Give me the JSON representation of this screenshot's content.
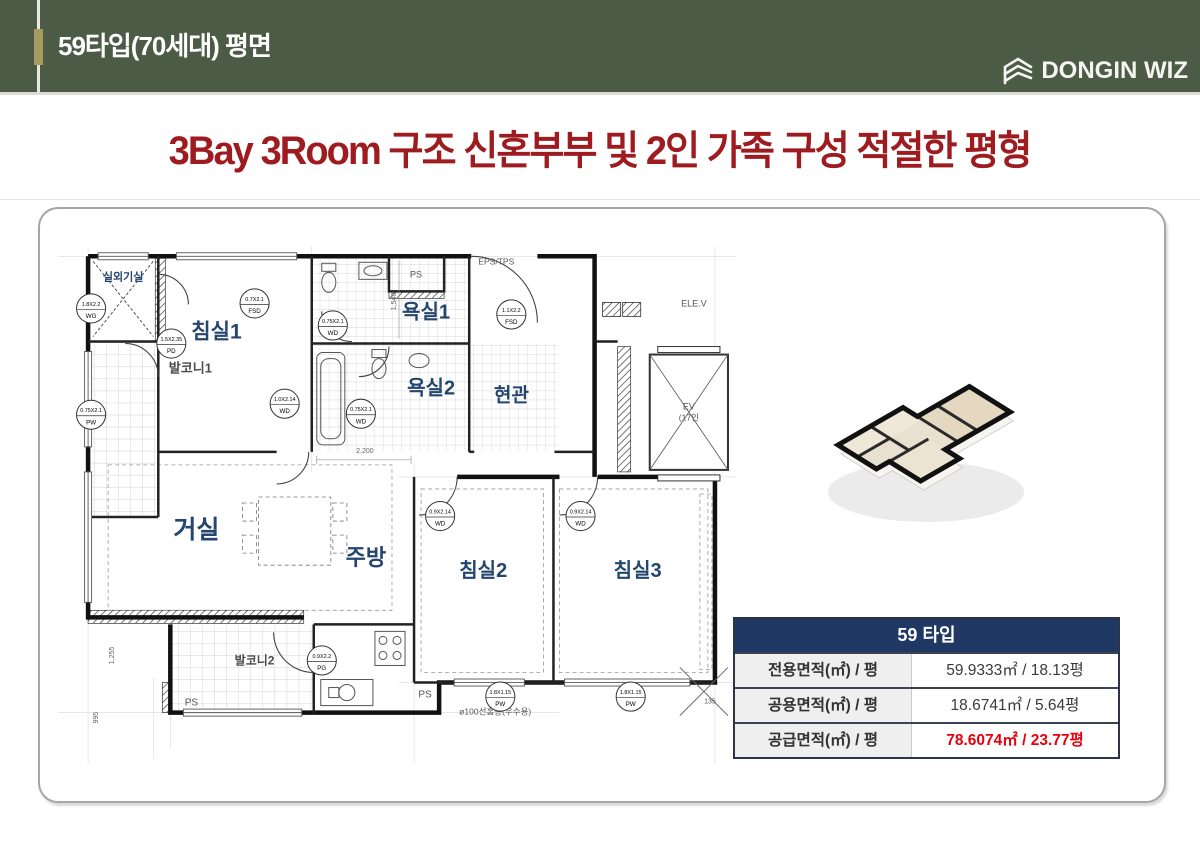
{
  "header": {
    "title": "59타입(70세대) 평면",
    "logo_text": "DONGIN WIZ",
    "bg_color": "#4c5b45",
    "accent_color": "#a69a5e"
  },
  "headline": {
    "text": "3Bay 3Room 구조 신혼부부 및 2인 가족 구성 적절한 평형",
    "color": "#9e1c20"
  },
  "floorplan": {
    "label_color": "#23456e",
    "room_labels": [
      {
        "text": "실외기실",
        "x": 65,
        "y": 34,
        "size": 11
      },
      {
        "text": "침실1",
        "x": 158,
        "y": 92,
        "size": 21
      },
      {
        "text": "욕실1",
        "x": 367,
        "y": 72,
        "size": 20
      },
      {
        "text": "욕실2",
        "x": 372,
        "y": 148,
        "size": 20
      },
      {
        "text": "현관",
        "x": 452,
        "y": 155,
        "size": 19
      },
      {
        "text": "거실",
        "x": 138,
        "y": 291,
        "size": 25
      },
      {
        "text": "주방",
        "x": 307,
        "y": 318,
        "size": 22
      },
      {
        "text": "침실2",
        "x": 424,
        "y": 330,
        "size": 20
      },
      {
        "text": "침실3",
        "x": 578,
        "y": 330,
        "size": 20
      },
      {
        "text": "발코니1",
        "x": 132,
        "y": 126,
        "size": 13,
        "color": "#4a4a4a"
      },
      {
        "text": "발코니2",
        "x": 196,
        "y": 417,
        "size": 12,
        "color": "#4a4a4a"
      }
    ],
    "cad_labels": [
      {
        "text": "PS",
        "x": 357,
        "y": 31,
        "size": 9
      },
      {
        "text": "EPS/TPS",
        "x": 437,
        "y": 18,
        "size": 8.5
      },
      {
        "text": "ELE.V",
        "x": 634,
        "y": 60,
        "size": 9
      },
      {
        "text": "EV",
        "x": 629,
        "y": 163,
        "size": 9
      },
      {
        "text": "(17인",
        "x": 629,
        "y": 174,
        "size": 8.5
      },
      {
        "text": "PS",
        "x": 133,
        "y": 458,
        "size": 10
      },
      {
        "text": "PS",
        "x": 366,
        "y": 450,
        "size": 10
      },
      {
        "text": "ø100선홈통(우수용)",
        "x": 400,
        "y": 467,
        "size": 8.5,
        "anchor": "start"
      },
      {
        "text": "135",
        "x": 650,
        "y": 456,
        "size": 7
      }
    ],
    "dim_labels": [
      {
        "text": "2,200",
        "x": 306,
        "y": 206,
        "size": 7
      },
      {
        "text": "1,540",
        "x": 337,
        "y": 55,
        "size": 7,
        "rot": true
      },
      {
        "text": "1,255",
        "x": 56,
        "y": 408,
        "size": 7,
        "rot": true
      },
      {
        "text": "995",
        "x": 40,
        "y": 470,
        "size": 7,
        "rot": true
      }
    ],
    "door_tags": [
      {
        "l1": "1.8X2.2",
        "l2": "WG",
        "x": 33,
        "y": 62
      },
      {
        "l1": "0.75X2.1",
        "l2": "PW",
        "x": 33,
        "y": 168
      },
      {
        "l1": "0.7X2.1",
        "l2": "FSD",
        "x": 196,
        "y": 57
      },
      {
        "l1": "1.5X2.35",
        "l2": "PD",
        "x": 113,
        "y": 97
      },
      {
        "l1": "0.75X2.1",
        "l2": "WD",
        "x": 274,
        "y": 79
      },
      {
        "l1": "1.1X2.2",
        "l2": "FSD",
        "x": 452,
        "y": 68
      },
      {
        "l1": "1.0X2.14",
        "l2": "WD",
        "x": 226,
        "y": 157
      },
      {
        "l1": "0.75X2.1",
        "l2": "WD",
        "x": 302,
        "y": 167
      },
      {
        "l1": "0.9X2.14",
        "l2": "WD",
        "x": 381,
        "y": 269
      },
      {
        "l1": "0.9X2.14",
        "l2": "WD",
        "x": 521,
        "y": 269
      },
      {
        "l1": "0.9X2.2",
        "l2": "PG",
        "x": 263,
        "y": 413
      },
      {
        "l1": "1.8X1.15",
        "l2": "PW",
        "x": 441,
        "y": 449
      },
      {
        "l1": "1.8X1.15",
        "l2": "PW",
        "x": 571,
        "y": 449
      }
    ]
  },
  "spec_table": {
    "title": "59 타입",
    "header_bg": "#1f3864",
    "highlight_color": "#e8000d",
    "rows": [
      {
        "label": "전용면적(㎡) / 평",
        "value": "59.9333㎡ / 18.13평"
      },
      {
        "label": "공용면적(㎡) / 평",
        "value": "18.6741㎡ / 5.64평"
      },
      {
        "label": "공급면적(㎡) / 평",
        "value": "78.6074㎡ / 23.77평"
      }
    ]
  }
}
